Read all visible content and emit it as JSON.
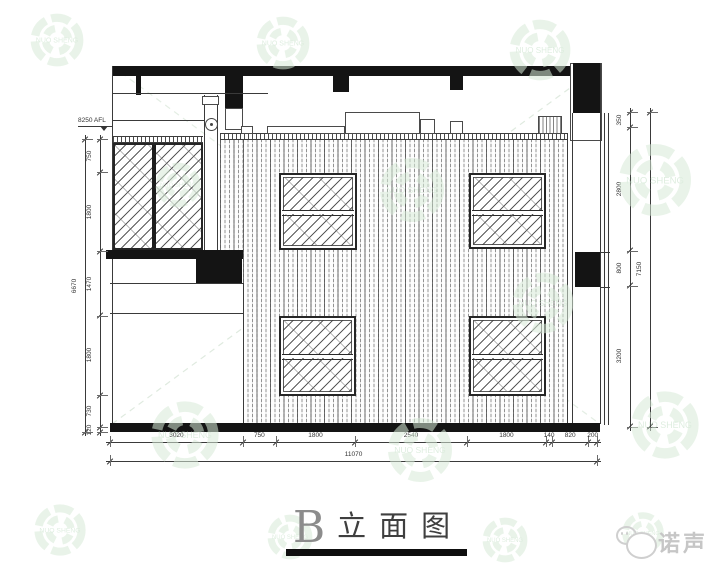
{
  "title": {
    "prefix": "B",
    "text": "立面图"
  },
  "level_label": {
    "text": "8250 AFL"
  },
  "dimensions": {
    "bottom": {
      "segments": [
        3020,
        750,
        1800,
        2540,
        1800,
        140,
        820,
        200
      ],
      "total": 11070
    },
    "left": {
      "segments": [
        750,
        1800,
        1470,
        1800,
        730,
        120
      ],
      "total": 6670
    },
    "right": {
      "segments": [
        350,
        2800,
        800,
        3200
      ],
      "total": 7150
    }
  },
  "watermark": {
    "brand": "NUO SHENG",
    "ring_color": "#d8ebd8",
    "text_color": "#c3dfc5"
  },
  "footer_brand": {
    "text": "诺声",
    "color": "#c6c6c6"
  },
  "drawing": {
    "ink": "#2b2b2b",
    "fill_black": "#141414",
    "name": "B elevation"
  }
}
